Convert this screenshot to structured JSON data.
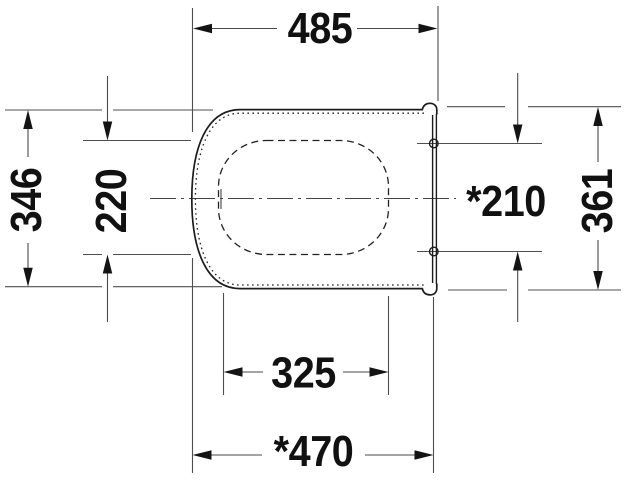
{
  "diagram": {
    "type": "technical-dimension-drawing",
    "subject": "toilet seat with cover, top view",
    "labels": {
      "overall_width": "485",
      "seat_depth": "346",
      "opening_depth": "220",
      "hinge_spacing": "*210",
      "cover_depth": "361",
      "inner_width": "325",
      "seat_width": "*470"
    },
    "colors": {
      "background": "#ffffff",
      "thin_line": "#4f4f4f",
      "outline": "#1c1c1c",
      "text": "#111111"
    }
  }
}
